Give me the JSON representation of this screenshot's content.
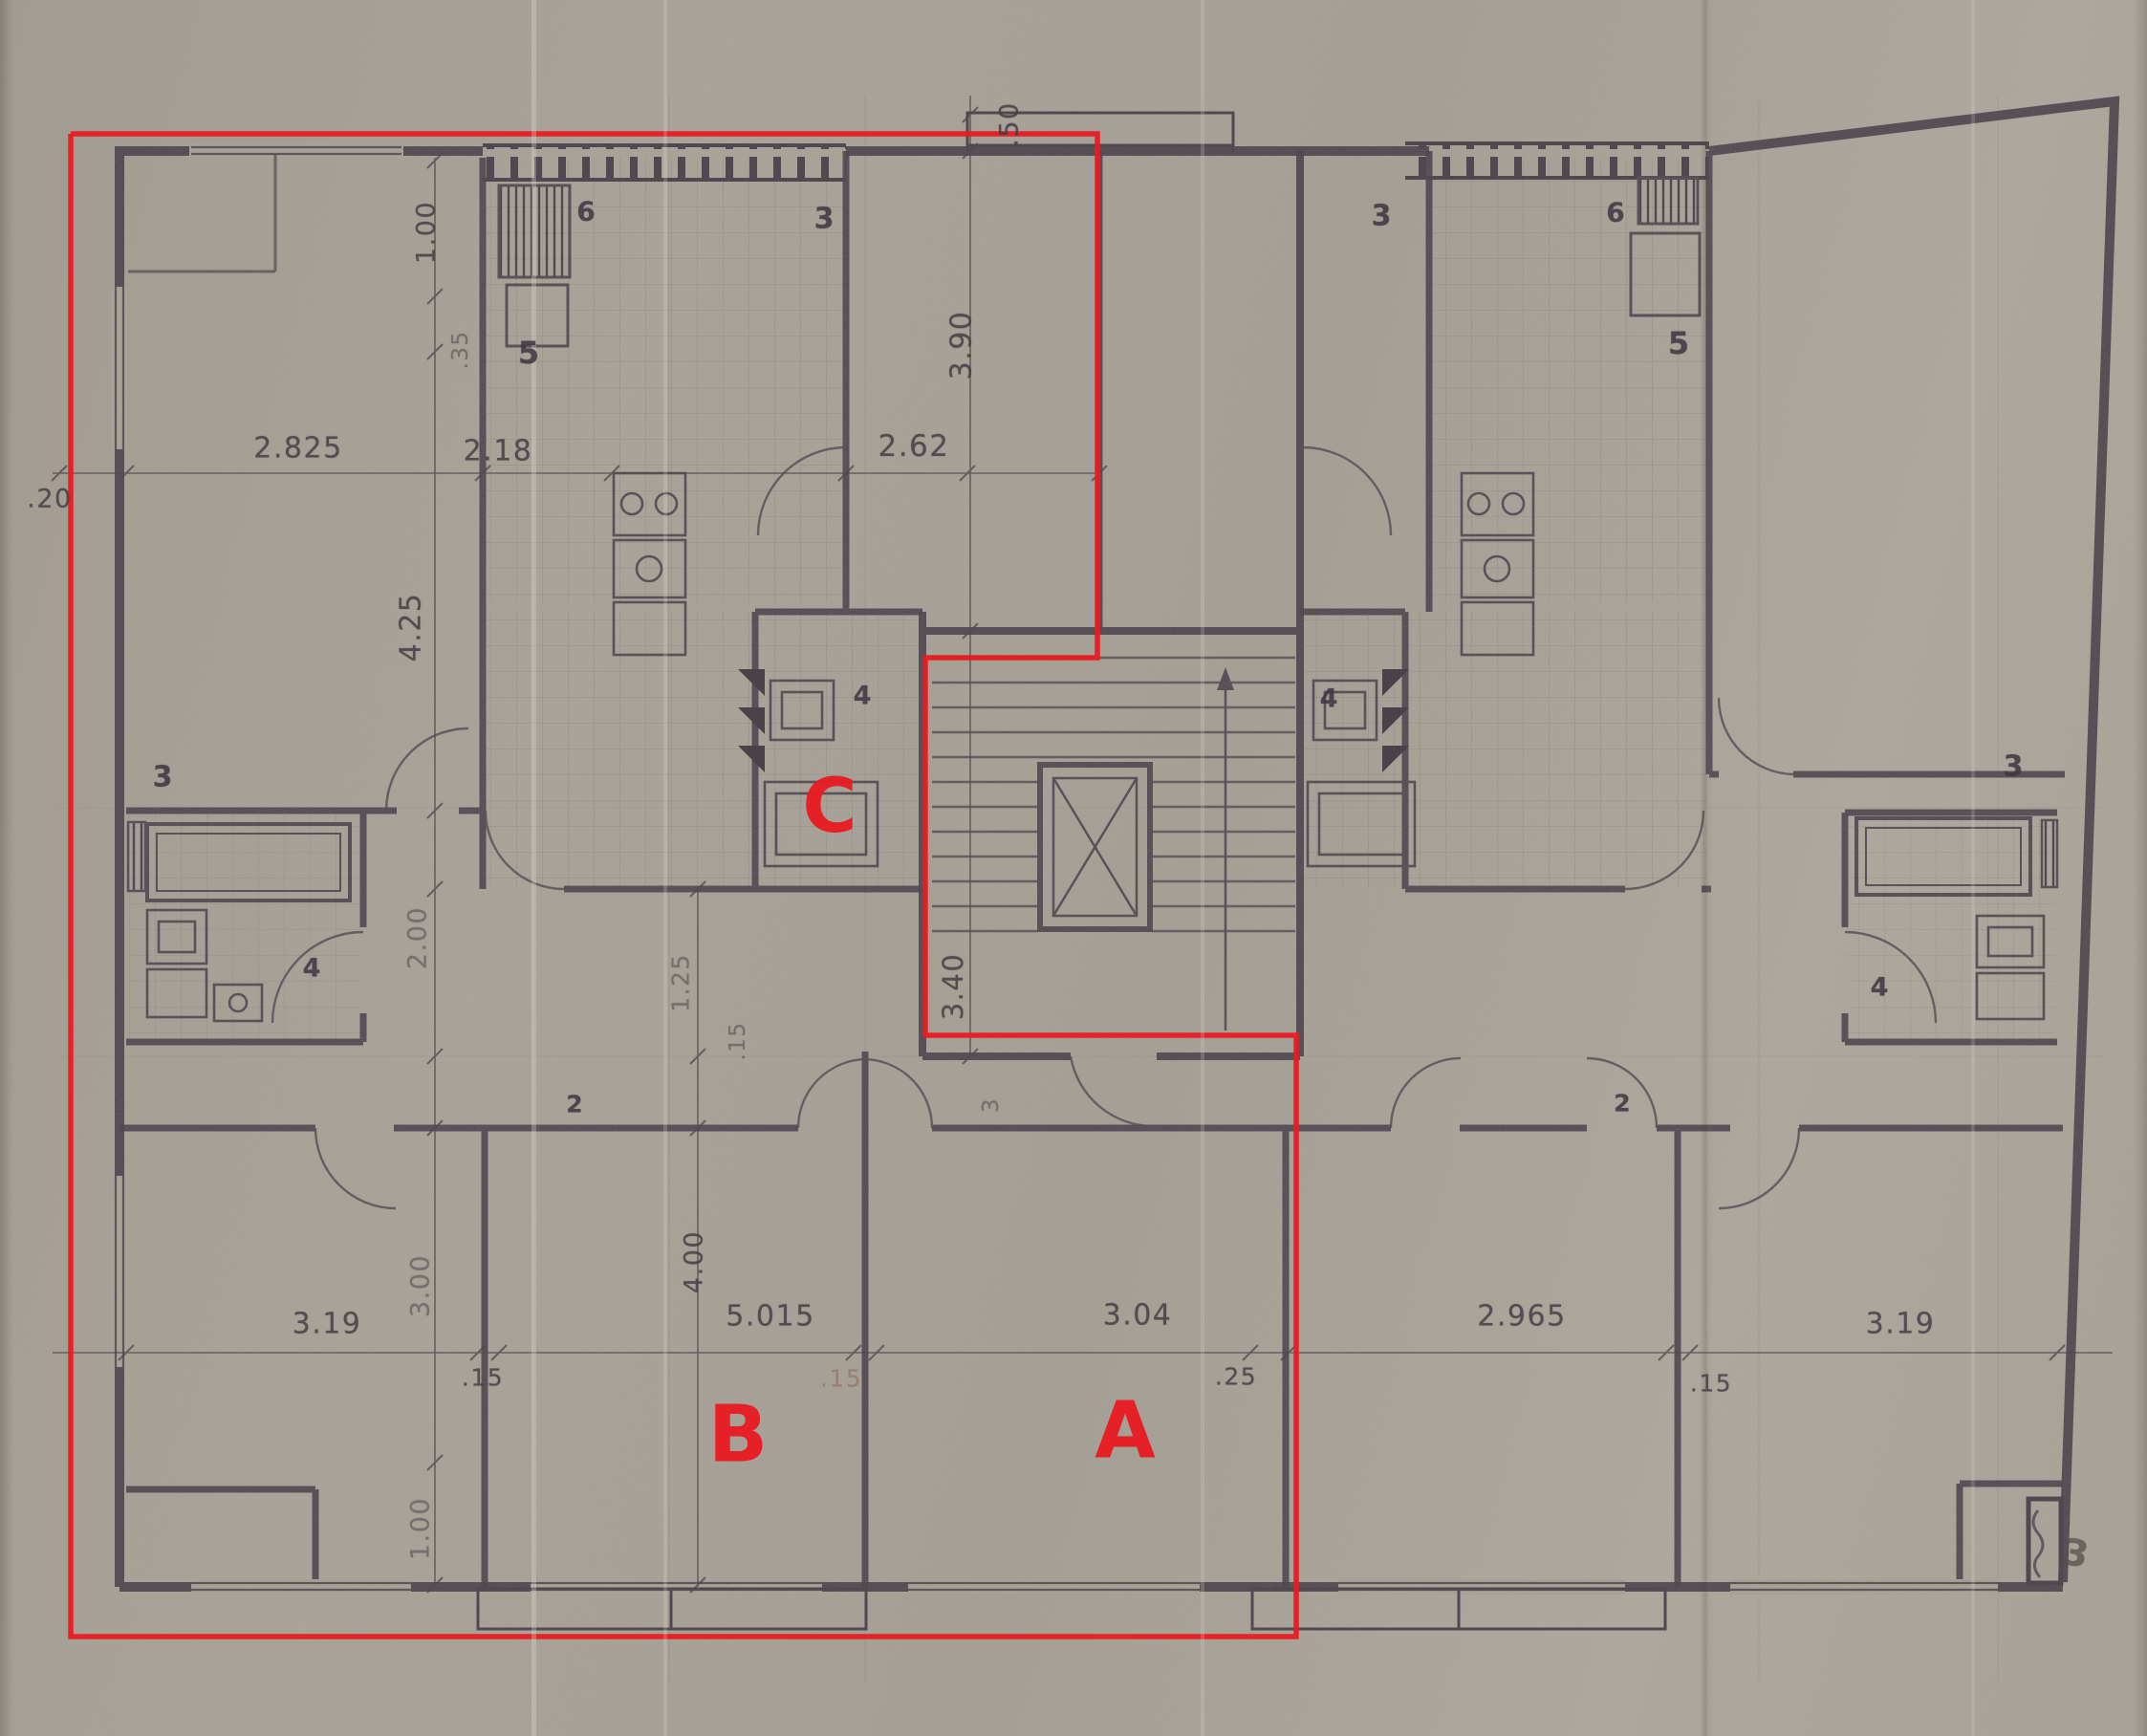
{
  "drawing": {
    "type": "apartment-building-floor-plan-scan",
    "ink_color": "#3f3742",
    "paper_color": "#a9a399",
    "overlay_color": "#e81b22"
  },
  "dims": {
    "w2825": "2.825",
    "w218": "2.18",
    "w262": "2.62",
    "w020": ".20",
    "w319L": "3.19",
    "w015a": ".15",
    "w5015": "5.015",
    "w015b": ".15",
    "w304": "3.04",
    "w025": ".25",
    "w2965": "2.965",
    "w015c": ".15",
    "w319R": "3.19",
    "v050": ".50",
    "v100t": "1.00",
    "v035": ".35",
    "v390": "3.90",
    "v425": "4.25",
    "v200": "2.00",
    "v125": "1.25",
    "v015": ".15",
    "v340": "3.40",
    "v3": "3",
    "v300": "3.00",
    "v400": "4.00",
    "v100b": "1.00"
  },
  "rooms_left": {
    "wc_small": "6",
    "living": "3",
    "kitchen": "5",
    "bath_core": "4",
    "bedroom": "3",
    "bath": "4",
    "hall": "2"
  },
  "rooms_right": {
    "living": "3",
    "wc_small": "6",
    "kitchen": "5",
    "bath_core": "4",
    "hall": "2",
    "bedroom": "3",
    "bath": "4"
  },
  "red_overlay": {
    "unit_a": "A",
    "unit_b": "B",
    "unit_c": "C"
  },
  "note": {
    "handwritten": "3"
  }
}
